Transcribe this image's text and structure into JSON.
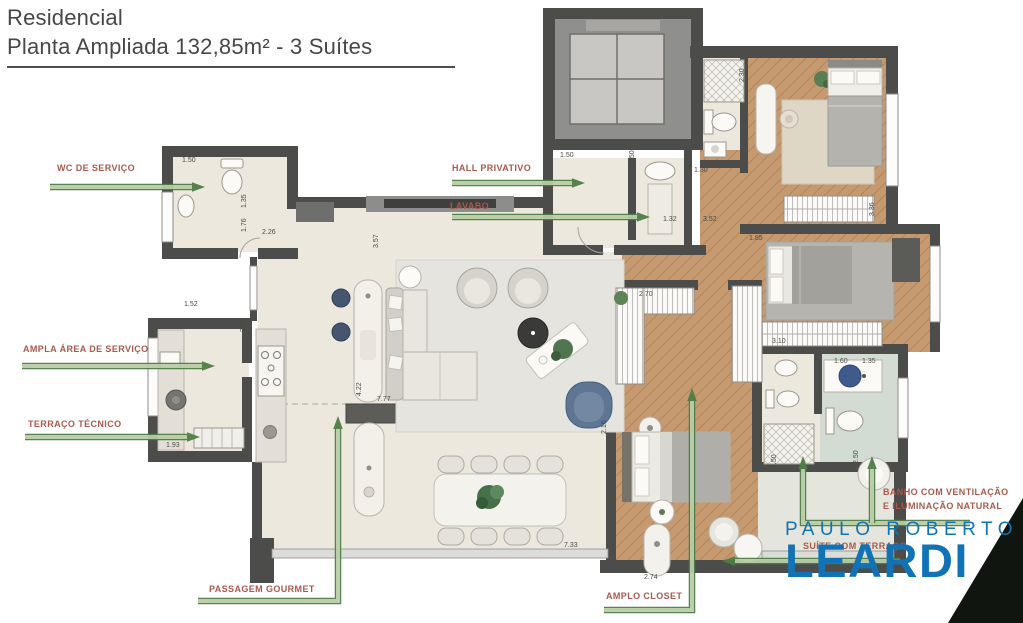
{
  "title": {
    "line1": "Residencial",
    "line2": "Planta Ampliada 132,85m² - 3 Suítes"
  },
  "callouts": [
    {
      "id": "wc-de-servico",
      "label": "WC DE SERVIÇO",
      "arrows": [
        {
          "points": [
            [
              50,
              187
            ],
            [
              205,
              187
            ]
          ]
        }
      ]
    },
    {
      "id": "hall-privativo",
      "label": "HALL PRIVATIVO",
      "arrows": [
        {
          "points": [
            [
              452,
              183
            ],
            [
              585,
              183
            ]
          ]
        }
      ]
    },
    {
      "id": "lavabo",
      "label": "LAVABO",
      "arrows": [
        {
          "points": [
            [
              452,
              217
            ],
            [
              650,
              217
            ]
          ]
        }
      ]
    },
    {
      "id": "ampla-area-de-servico",
      "label": "AMPLA ÁREA DE SERVIÇO",
      "arrows": [
        {
          "points": [
            [
              22,
              366
            ],
            [
              215,
              366
            ]
          ]
        }
      ]
    },
    {
      "id": "terraco-tecnico",
      "label": "TERRAÇO TÉCNICO",
      "arrows": [
        {
          "points": [
            [
              25,
              437
            ],
            [
              200,
              437
            ]
          ]
        }
      ]
    },
    {
      "id": "passagem-gourmet",
      "label": "PASSAGEM GOURMET",
      "arrows": [
        {
          "points": [
            [
              198,
              601
            ],
            [
              338,
              601
            ],
            [
              338,
              416
            ]
          ]
        }
      ]
    },
    {
      "id": "amplo-closet",
      "label": "AMPLO CLOSET",
      "arrows": [
        {
          "points": [
            [
              604,
              610
            ],
            [
              692,
              610
            ],
            [
              692,
              388
            ]
          ]
        }
      ]
    },
    {
      "id": "suite-com-terraco",
      "label": "SUÍTE COM TERRAÇO",
      "arrows": [
        {
          "points": [
            [
              900,
              561
            ],
            [
              722,
              561
            ]
          ]
        }
      ]
    },
    {
      "id": "banho-ventilacao",
      "label": "BANHO COM VENTILAÇÃO E ILUMINAÇÃO NATURAL",
      "arrows": [
        {
          "points": [
            [
              970,
              523
            ],
            [
              803,
              523
            ],
            [
              803,
              456
            ]
          ]
        },
        {
          "points": [
            [
              872,
              523
            ],
            [
              872,
              456
            ]
          ]
        }
      ]
    }
  ],
  "dimensions": [
    {
      "text": "1.50",
      "x": 182,
      "y": 162,
      "rot": 0
    },
    {
      "text": "1.35",
      "x": 246,
      "y": 208,
      "rot": -90
    },
    {
      "text": "1.76",
      "x": 246,
      "y": 232,
      "rot": -90
    },
    {
      "text": "2.26",
      "x": 262,
      "y": 234,
      "rot": 0
    },
    {
      "text": "1.52",
      "x": 184,
      "y": 306,
      "rot": 0
    },
    {
      "text": "2.77",
      "x": 245,
      "y": 332,
      "rot": -90
    },
    {
      "text": "1.93",
      "x": 166,
      "y": 447,
      "rot": 0
    },
    {
      "text": "3.57",
      "x": 378,
      "y": 248,
      "rot": -90
    },
    {
      "text": "4.22",
      "x": 361,
      "y": 396,
      "rot": -90
    },
    {
      "text": "7.77",
      "x": 377,
      "y": 401,
      "rot": 0
    },
    {
      "text": "7.33",
      "x": 564,
      "y": 547,
      "rot": 0
    },
    {
      "text": "2.16",
      "x": 606,
      "y": 434,
      "rot": -90
    },
    {
      "text": "1.50",
      "x": 560,
      "y": 157,
      "rot": 0
    },
    {
      "text": "1.50",
      "x": 634,
      "y": 164,
      "rot": -90
    },
    {
      "text": "1.30",
      "x": 694,
      "y": 172,
      "rot": 0
    },
    {
      "text": "1.32",
      "x": 663,
      "y": 221,
      "rot": 0
    },
    {
      "text": "3.52",
      "x": 703,
      "y": 221,
      "rot": 0
    },
    {
      "text": "1.85",
      "x": 749,
      "y": 240,
      "rot": 0
    },
    {
      "text": "2.30",
      "x": 744,
      "y": 82,
      "rot": -90
    },
    {
      "text": "3.36",
      "x": 874,
      "y": 216,
      "rot": -90
    },
    {
      "text": "2.70",
      "x": 639,
      "y": 296,
      "rot": 0
    },
    {
      "text": "3.10",
      "x": 772,
      "y": 343,
      "rot": 0
    },
    {
      "text": "1.60",
      "x": 834,
      "y": 363,
      "rot": 0
    },
    {
      "text": "1.35",
      "x": 862,
      "y": 363,
      "rot": 0
    },
    {
      "text": "2.50",
      "x": 776,
      "y": 468,
      "rot": -90
    },
    {
      "text": "2.50",
      "x": 858,
      "y": 464,
      "rot": -90
    },
    {
      "text": "2.74",
      "x": 644,
      "y": 579,
      "rot": 0
    }
  ],
  "logo": {
    "line1": "PAULO ROBERTO",
    "line2": "LEARDI"
  },
  "colors": {
    "wall": "#4c4c4a",
    "floor_cream": "#ede8de",
    "wood": "#c69a70",
    "bath_tile": "#d3dcd2",
    "terrace": "#e4e6de",
    "arrow_fill": "#b8cda6",
    "arrow_stroke": "#4e7d46",
    "callout_text": "#a85a4c",
    "title_text": "#474747",
    "logo_blue": "#1173b5",
    "corner_triangle": "#10150f"
  }
}
